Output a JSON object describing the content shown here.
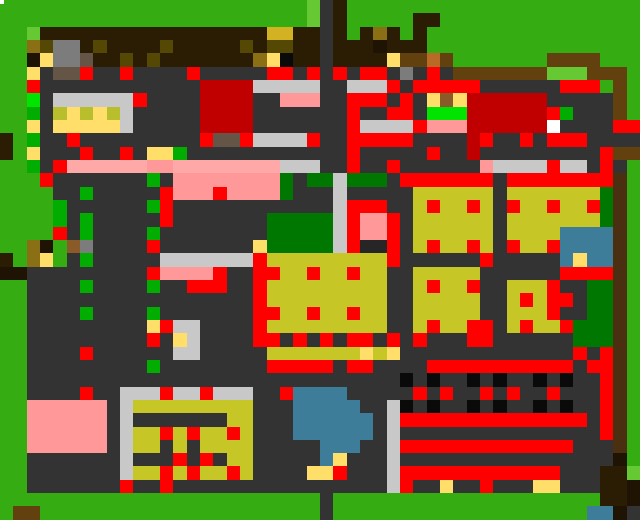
{
  "meta": {
    "app": "pixel-village-map",
    "view": "overworld",
    "width_px": 640,
    "height_px": 520,
    "grid_cols": 48,
    "grid_rows": 39
  },
  "palette": {
    "G": "#35AC12",
    "L": "#66C832",
    "g": "#00AD00",
    "E": "#00E400",
    "D": "#007700",
    "B": "#2A1D03",
    "k": "#1F1403",
    "K": "#0A0A0A",
    "o": "#8A6F15",
    "O": "#554805",
    "S": "#D2B222",
    "w": "#63410F",
    "v": "#4A2F10",
    "c": "#B96A26",
    "h": "#8A5A28",
    "n": "#655546",
    "A": "#7C7C7C",
    "C": "#C8C8C8",
    "F": "#333333",
    "f": "#262626",
    "Y": "#FFDE69",
    "y": "#C6C626",
    "d": "#B8BE2C",
    "R": "#FF0000",
    "r": "#C00000",
    "P": "#FF9999",
    "p": "#FFA8A8",
    "T": "#3E7D99",
    "W": "#FFFFFF"
  },
  "grid": {
    "rows": [
      "GGGGGGGGGGGGGGGGGGGGGGGLFBGGGGGGGGGGGGGGGGGGGGGG",
      "GGGGGGGGGGGGGGGGGGGGGGGLFBGGGGGBBGGGGGGGGGGGGGGG",
      "GGLBBBBBBBBBBBBBBBBBSSBBFBGBoBGBGGGGGGGGGGGGGGGG",
      "GGoOAABOBBBBOBBBBBOBOOBBFBBBkBBBGGGGGGGGGGGGGGGG",
      "GGkYAAnBBOBOBBBBBBBoYKBBFBBBBYwwcwGGGGGGGwwwwGGG",
      "GGYFnnRFFRFFFFRFFFFFRRFRFRFRRFAFRFwwwwwwwLLLwwwG",
      "GGRFFFFFFFFFFFFrrrrCCCCCFFCCCRFRRRRRFFFFFFRRRGwG",
      "GGEFCCCCCCRFFFFrrrrFFPPPFFRRRFRFYhYrrrrrrFFFFFwG",
      "GGgFdYdYdCFFFFFrrrrFFFFFFFRFFRRFEEErrrrrrRgFFFwG",
      "GGYFYYYYYCFFFFFrrrrFFFFFFFRCCCCRPPPrrrrrrWFFFFRR",
      "BGgFFRFFFFFFFFFRnnRCCCCRFFRRRRRFFFFrRFFRFRRRFFFF",
      "BGYFFFRFFRFYYgFFFFFFFFFFFFRFFFFFRFFrFFFFFFFFFRww",
      "GGgFRppppppPPppppppppCCCFFRFFRFFFFFFPCCCCRCCFRFG",
      "GGGRFFFFFFFgFPPPPPPPPDFDDCDDDFRRRRRRRFRRRRRRRRvG",
      "GGGGFFgFFFFFRPPPRPPPPDFFFCFFFFFyyyyyyFyyyyyyyDvG",
      "GGGGgFFFFFFgRFFFFFFFFFFFFCRRRFFyRyyRyFRyyRyyRDvG",
      "GGGGgFgFFFFFRFFFFFFFDDDDDCRPPRFyyyyyyFyyyyyyyDvG",
      "GGGGRFgFFFFgFFFFFFFFDDDDDCRPPRFyyyyyyFyyyyTTTTvG",
      "GGokGhAFFFFRFFFFFFFYDDDDDCRffRFyRyyRyFRyyRTTTTvG",
      "BGoYGFgFFFFFCCCCCCCRyyyyyyyyyRFFFFFFRFFFFFTYTTvG",
      "kkFFFFFFFFFRPPPPRFFRRyyRyyRyyFFyyyyyFFFFFFRRRRvG",
      "GGFFFFgFFFFgFFRRRFFRyyyyyyyyyFFyRyyRFFyyyRFFDDvG",
      "GGFFFFFFFFFFFFFFFFFRyyyyyyyyyFFyyyyyFFyRyRRFDDvG",
      "GGFFFFgFFFFgFFFFFFFRRyyRyyRyyFFyyyyyFFyyyRFFDDvG",
      "GGFFFFFFFFFYRCCFFFFRyyyyyyyyyFFyRyyRRFyRyyRDDDvG",
      "GGFFFFFFFFFRFYCFFFFRRFRFRFRRFRFRFFFRRFFFFFFDDDvG",
      "GGFFFFRFFFFFFCCFFFFFyyyyyyyYyYFFFFFFFFFFFFFRFRvG",
      "GGFFFFFFFFFgFFFFFFFFRRRRRFRRFFFFRRRRRRRRRRRFRRvG",
      "GGFFFFFFFFFFFFFFFFFFFFFFFFFFFFKFKFFKFKFFKFKFFRvG",
      "GGFFFFRFFCCCRCCRCCCFFRTTTTFFFFFRFRFFRFRFFRFFFRvG",
      "GGPPPPPPFCyyyyyyyyyFFFTTTTTFFCKFKFFKFKFFKFKFFRvG",
      "GGPPPPPPFCFFFFFFFyyFFFTTTTTTFCRRRRRRRRRRRRRRFRvG",
      "GGPPPPPPFCyyRyRyyRyFFFTTTTTTFCFFFFFFFFFFFFFFFRvG",
      "GGPPPPPPFCyyFyFyyyyFFFFFTTTFFCRRRRRRRRRRRRRFFFvG",
      "GGFFFFFFFCFFFRFRFyyFFFFFTYFFFCFFFFFFFFFFFFFFFFkG",
      "GGFFFFFFFCyyRyRyyRyFFFFYYRFFFCRRRRRRRRRRRRFFFBBL",
      "GGFFFFFFFRFFRFFFFFFFFFFFFFFFFCRFFYFFRFFFYYFFFBBk",
      "GGGGGGGGGGGGGGGGGGGGGGGGFGGGGGGGGGGGGGGGGGGGGBBk",
      "GwwGGGGGGGGGGGGGGGGGGGGGFGGGGGGGGGGGGGGGGGGGTTk"
    ]
  },
  "white_dot": {
    "x": 0,
    "y": 0,
    "w": 4,
    "h": 4
  },
  "landmarks": [
    {
      "name": "landmark-main-road-vertical",
      "x": 320,
      "y": 0,
      "w": 27,
      "h": 520
    },
    {
      "name": "landmark-yellow-hall-northwest",
      "x": 49,
      "y": 96,
      "w": 80,
      "h": 41
    },
    {
      "name": "landmark-dark-red-warehouse",
      "x": 200,
      "y": 80,
      "w": 56,
      "h": 47
    },
    {
      "name": "landmark-dark-red-barn-east",
      "x": 480,
      "y": 88,
      "w": 64,
      "h": 49
    },
    {
      "name": "landmark-saloon-with-npc",
      "x": 344,
      "y": 87,
      "w": 72,
      "h": 58
    },
    {
      "name": "landmark-pink-plaza",
      "x": 176,
      "y": 174,
      "w": 103,
      "h": 25
    },
    {
      "name": "landmark-red-shrine-pink-roof",
      "x": 351,
      "y": 206,
      "w": 41,
      "h": 48
    },
    {
      "name": "landmark-crop-field-northeast",
      "x": 415,
      "y": 183,
      "w": 185,
      "h": 71
    },
    {
      "name": "landmark-crop-field-central",
      "x": 255,
      "y": 255,
      "w": 137,
      "h": 79
    },
    {
      "name": "landmark-crop-field-east",
      "x": 415,
      "y": 263,
      "w": 65,
      "h": 71
    },
    {
      "name": "landmark-crop-field-south",
      "x": 503,
      "y": 280,
      "w": 49,
      "h": 54
    },
    {
      "name": "landmark-pond-small-east",
      "x": 560,
      "y": 223,
      "w": 47,
      "h": 58
    },
    {
      "name": "landmark-pond-large",
      "x": 293,
      "y": 386,
      "w": 80,
      "h": 87
    },
    {
      "name": "landmark-garden-plots",
      "x": 160,
      "y": 400,
      "w": 96,
      "h": 87
    },
    {
      "name": "landmark-pink-house-west",
      "x": 24,
      "y": 399,
      "w": 88,
      "h": 48
    },
    {
      "name": "landmark-greenhouse-shelves",
      "x": 119,
      "y": 391,
      "w": 41,
      "h": 90
    },
    {
      "name": "landmark-striped-depot",
      "x": 400,
      "y": 360,
      "w": 200,
      "h": 130
    },
    {
      "name": "landmark-brown-house-southeast",
      "x": 600,
      "y": 447,
      "w": 40,
      "h": 73
    }
  ]
}
